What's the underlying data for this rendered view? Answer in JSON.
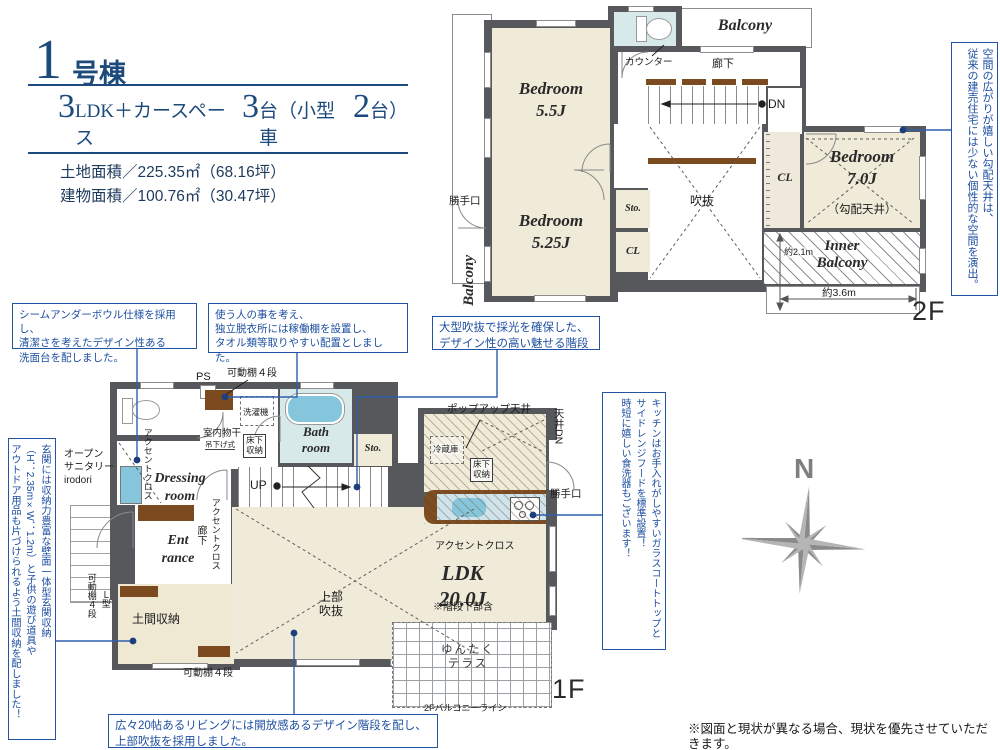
{
  "header": {
    "num": "1",
    "suffix": "号棟",
    "spec_n1": "3",
    "spec_t1": "LDK＋カースペース",
    "spec_n2": "3",
    "spec_t2": "台（小型車",
    "spec_n3": "2",
    "spec_t3": "台）",
    "land": "土地面積／225.35㎡（68.16坪）",
    "bldg": "建物面積／100.76㎡（30.47坪）"
  },
  "p2": {
    "balcony_left": "Balcony",
    "balcony_top": "Balcony",
    "bed55": "Bedroom\n5.5J",
    "bed525": "Bedroom\n5.25J",
    "bed7": "Bedroom\n7.0J",
    "slope": "（勾配天井）",
    "counter": "カウンター",
    "roka": "廊下",
    "dn": "DN",
    "fukinuke": "吹抜",
    "sto": "Sto.",
    "cl_mid": "CL",
    "cl_right": "CL",
    "katteguchi": "勝手口",
    "inner": "Inner\nBalcony",
    "dim_v": "約2.1m",
    "dim_h": "約3.6m",
    "flabel": "2F"
  },
  "p1": {
    "open_sanitary": "オープン\nサニタリー\nirodori",
    "accent_wash": "アクセントクロス",
    "accent_hall": "アクセントクロス",
    "accent_ldk": "アクセントクロス",
    "ps": "PS",
    "shelf_top": "可動棚４段",
    "washer": "洗濯機",
    "monohoshi": "室内物干",
    "tsurishiki": "吊下げ式",
    "yukashita_wash": "床下\n収納",
    "yukashita_kitchen": "床下\n収納",
    "bath": "Bath\nroom",
    "sto": "Sto.",
    "dressing": "Dressing\nroom",
    "up": "UP",
    "entrance": "Ent\nrance",
    "roka": "廊下",
    "shelf_left": "可動棚４段",
    "ltype": "Ｌ型",
    "doma": "土間収納",
    "shelf_btm": "可動棚４段",
    "jyoubu": "上部\n吹抜",
    "popup": "ポップアップ天井",
    "fridge": "冷蔵庫",
    "tenjo_dn": "天井DN",
    "katteguchi": "勝手口",
    "ldk": "LDK\n20.0J",
    "ldk_note": "※階段下部含",
    "terrace": "ゆんたく\nテラス",
    "bline": "2Fバルコニーライン",
    "flabel": "1F"
  },
  "callouts": {
    "c1": "シームアンダーボウル仕様を採用し、\n清潔さを考えたデザイン性ある\n洗面台を配しました。",
    "c2": "使う人の事を考え、\n独立脱衣所には稼働棚を設置し、\nタオル類等取りやすい配置としました。",
    "c3": "大型吹抜で採光を確保した、\nデザイン性の高い魅せる階段",
    "c4": "キッチンはお手入れがしやすいガラスコートトップと\nサイドレンジフードを標準設置！\n時短に嬉しい食洗器もございます！",
    "c5": "玄関には収納力豊富な壁面一体型玄関収納\n（H：2.35m×W：1.2m）と子供の遊び道具や\nアウトドア用品も片づけられるよう土間収納を配しました！",
    "c6": "空間の広がりが嬉しい勾配天井は、\n従来の建売住宅には少ない個性的な空間を演出。",
    "c7": "広々20帖あるリビングには開放感あるデザイン階段を配し、\n上部吹抜を採用しました。"
  },
  "compass": {
    "n": "N"
  },
  "disclaimer": "※図面と現状が異なる場合、現状を優先させていただきます。"
}
